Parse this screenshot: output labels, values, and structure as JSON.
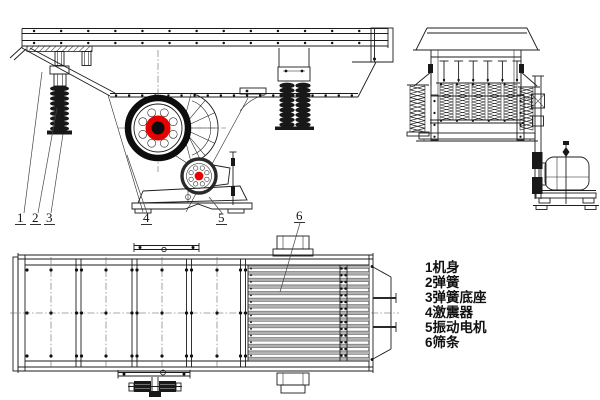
{
  "legend": {
    "items": [
      "1机身",
      "2弹簧",
      "3弹簧底座",
      "4激震器",
      "5振动电机",
      "6筛条"
    ]
  },
  "callouts": {
    "n1": "1",
    "n2": "2",
    "n3": "3",
    "n4": "4",
    "n5": "5",
    "n6": "6"
  },
  "colors": {
    "line": "#1c1c1c",
    "accent_red": "#e60000",
    "bar_gray": "#b0b0b0",
    "spring_black": "#181818",
    "background": "#ffffff"
  }
}
